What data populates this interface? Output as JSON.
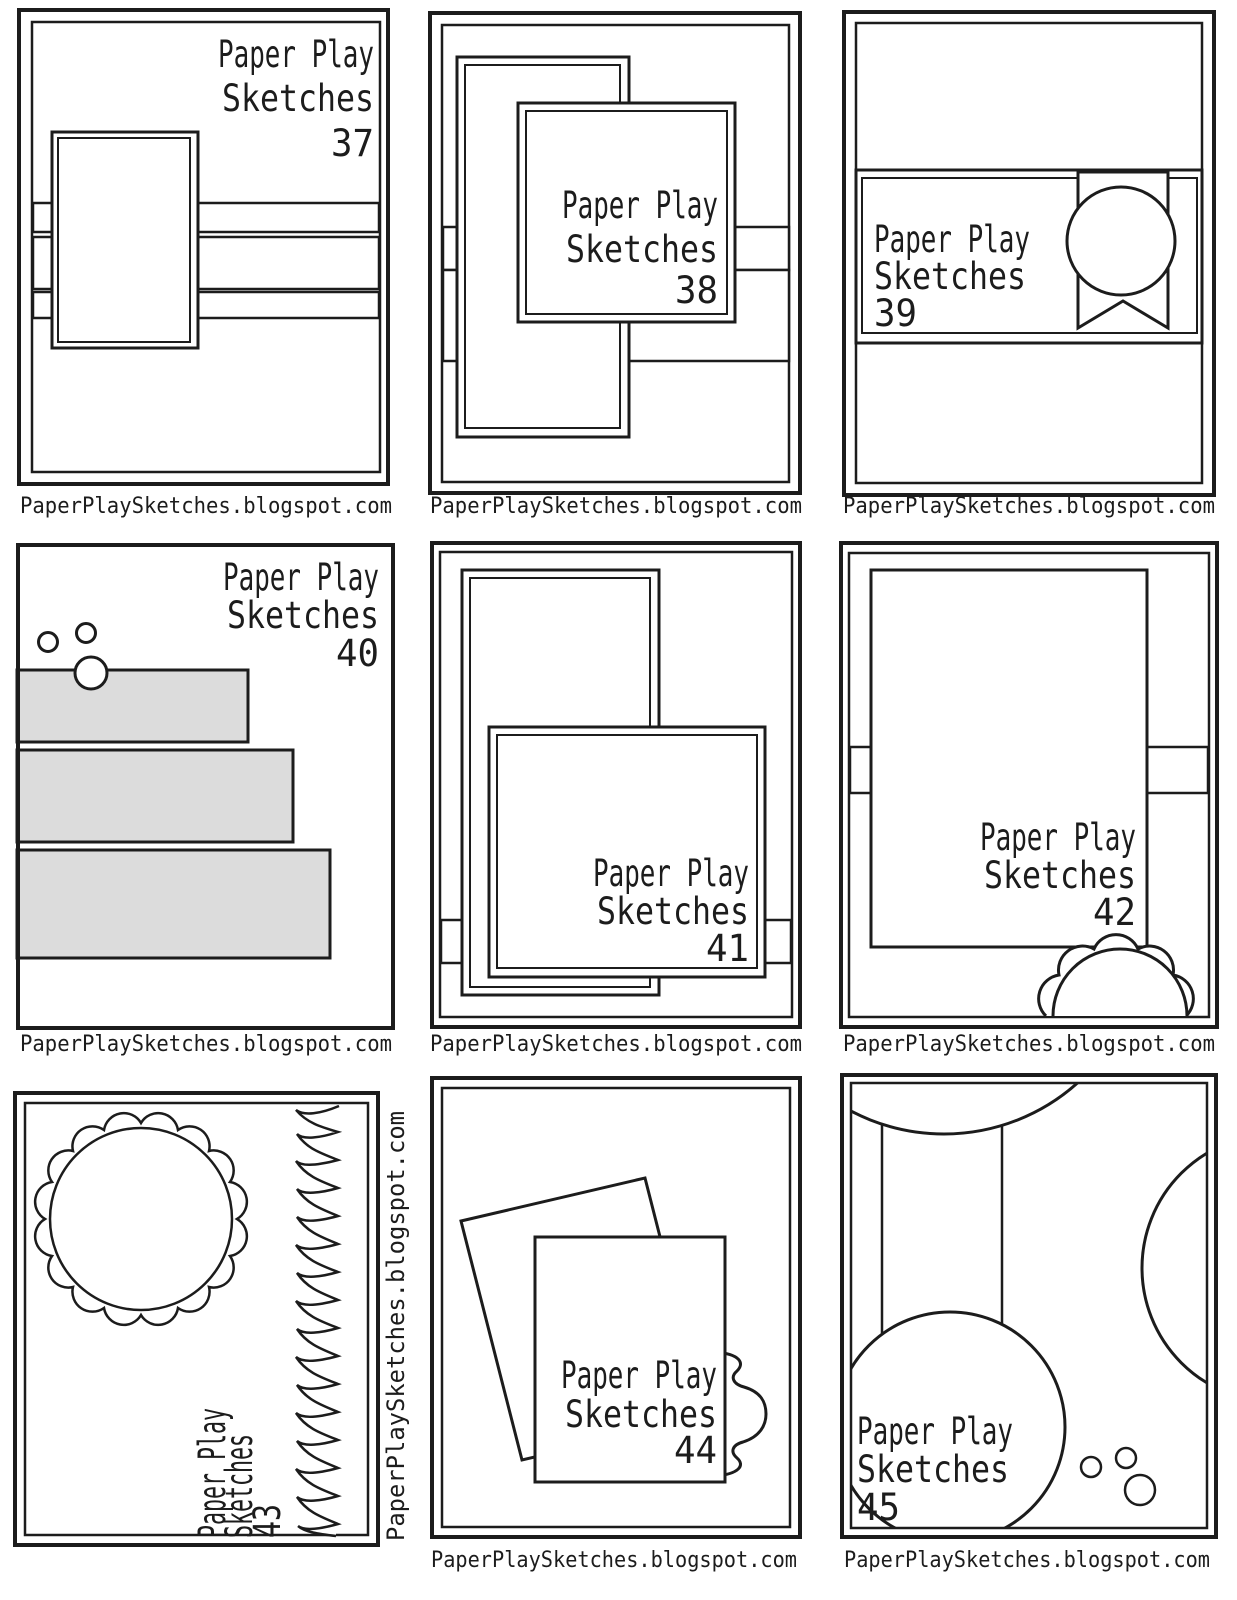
{
  "caption": "PaperPlaySketches.blogspot.com",
  "brand": {
    "line1": "Paper Play",
    "line2": "Sketches"
  },
  "sketches": [
    {
      "number": "37"
    },
    {
      "number": "38"
    },
    {
      "number": "39"
    },
    {
      "number": "40"
    },
    {
      "number": "41"
    },
    {
      "number": "42"
    },
    {
      "number": "43"
    },
    {
      "number": "44"
    },
    {
      "number": "45"
    }
  ],
  "colors": {
    "ink": "#1c1c1c",
    "paper": "#ffffff",
    "bar_fill": "#dcdcdc",
    "background": "#ffffff"
  }
}
